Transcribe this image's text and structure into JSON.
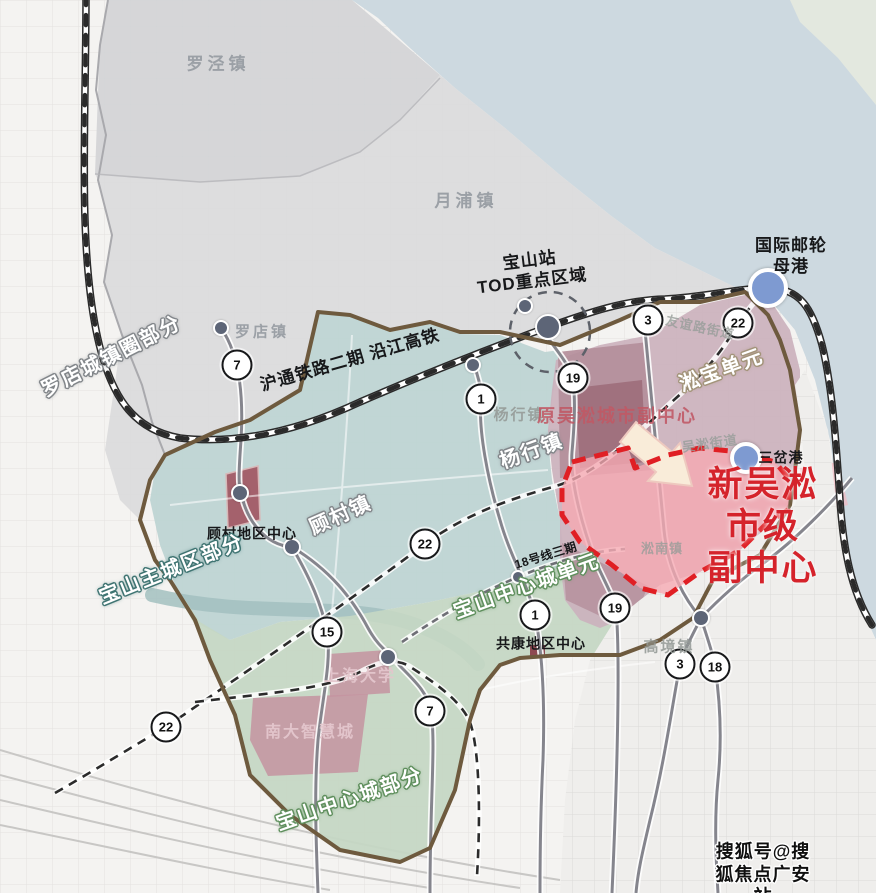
{
  "map": {
    "title_hint": "宝山区规划示意图",
    "colors": {
      "accent_red": "#d5232b",
      "dashed_zone_red": "#e01f24",
      "water": "#cdd9e0",
      "grey_region": "#d6d6d8",
      "teal_region": "#bdd3d2",
      "green_region": "#c5d7c4",
      "pink_region": "#cbb2bd",
      "pink_zone_fill": "#f6a9b2",
      "brown_boundary": "#6e5a3e",
      "port_marker_blue": "#7e9ad1"
    },
    "labels": [
      {
        "id": "luojing-town-label",
        "text": "罗泾镇",
        "x": 218,
        "y": 64,
        "rot": 0,
        "style": "town-grey"
      },
      {
        "id": "yuepu-town-label",
        "text": "月浦镇",
        "x": 466,
        "y": 201,
        "rot": 0,
        "style": "town-grey"
      },
      {
        "id": "luodian-town-label",
        "text": "罗店镇",
        "x": 262,
        "y": 333,
        "rot": 0,
        "style": "town-grey-sm"
      },
      {
        "id": "luodian-town-circle-part-label",
        "text": "罗店城镇圈部分",
        "x": 112,
        "y": 357,
        "rot": -27,
        "style": "outline sh-grey"
      },
      {
        "id": "hutong-railway-label",
        "text": "沪通铁路二期 沿江高铁",
        "x": 350,
        "y": 360,
        "rot": -16,
        "style": "black-bold md"
      },
      {
        "id": "baoshan-station-tod-label",
        "text": "宝山站\nTOD重点区域",
        "x": 531,
        "y": 271,
        "rot": -7,
        "style": "black-bold md"
      },
      {
        "id": "intl-cruise-port-label",
        "text": "国际邮轮母港",
        "x": 791,
        "y": 256,
        "rot": 0,
        "style": "black-bold md"
      },
      {
        "id": "songbao-unit-label",
        "text": "淞宝单元",
        "x": 722,
        "y": 371,
        "rot": -20,
        "style": "outline sh-tan"
      },
      {
        "id": "youyi-road-street-label",
        "text": "友谊路街道",
        "x": 700,
        "y": 328,
        "rot": 12,
        "style": "faded-grey-sm"
      },
      {
        "id": "yanghang-town-basemap-label",
        "text": "杨行镇",
        "x": 519,
        "y": 416,
        "rot": 0,
        "style": "faded-grey"
      },
      {
        "id": "former-wusong-city-subcenter-label",
        "text": "原吴淞城市副中心",
        "x": 617,
        "y": 416,
        "rot": 0,
        "style": "faded-red"
      },
      {
        "id": "yanghang-town-label",
        "text": "杨行镇",
        "x": 532,
        "y": 452,
        "rot": -20,
        "style": "outline sh-grey"
      },
      {
        "id": "wusong-street-label",
        "text": "吴淞街道",
        "x": 710,
        "y": 444,
        "rot": -8,
        "style": "faded-grey-sm"
      },
      {
        "id": "sanchagang-label",
        "text": "三岔港",
        "x": 781,
        "y": 458,
        "rot": 0,
        "style": "black-bold sm"
      },
      {
        "id": "new-wusong-city-subcenter-label",
        "text": "新吴淞市级\n副中心",
        "x": 763,
        "y": 527,
        "rot": 0,
        "style": "red-big"
      },
      {
        "id": "gucun-area-center-label",
        "text": "顾村地区中心",
        "x": 252,
        "y": 534,
        "rot": 0,
        "style": "black-bold sm"
      },
      {
        "id": "gucun-town-label",
        "text": "顾村镇",
        "x": 341,
        "y": 516,
        "rot": -24,
        "style": "outline sh-grey"
      },
      {
        "id": "baoshan-main-city-part-label",
        "text": "宝山主城区部分",
        "x": 172,
        "y": 570,
        "rot": -22,
        "style": "outline sh-teal"
      },
      {
        "id": "line18-phase3-label",
        "text": "18号线三期",
        "x": 546,
        "y": 556,
        "rot": -17,
        "style": "black-bold xs"
      },
      {
        "id": "songnan-town-label",
        "text": "淞南镇",
        "x": 662,
        "y": 549,
        "rot": 0,
        "style": "faded-grey-sm"
      },
      {
        "id": "baoshan-central-city-unit-label",
        "text": "宝山中心城单元",
        "x": 527,
        "y": 587,
        "rot": -20,
        "style": "outline sh-green"
      },
      {
        "id": "gongkang-area-center-label",
        "text": "共康地区中心",
        "x": 541,
        "y": 644,
        "rot": 0,
        "style": "black-bold sm"
      },
      {
        "id": "gaojing-town-label",
        "text": "高境镇",
        "x": 669,
        "y": 648,
        "rot": 0,
        "style": "faded-grey"
      },
      {
        "id": "shanghai-university-label",
        "text": "上海大学",
        "x": 360,
        "y": 677,
        "rot": 0,
        "style": "faded-pink"
      },
      {
        "id": "nanda-smart-city-label",
        "text": "南大智慧城",
        "x": 310,
        "y": 733,
        "rot": 0,
        "style": "faded-pink"
      },
      {
        "id": "baoshan-central-city-part-label",
        "text": "宝山中心城部分",
        "x": 350,
        "y": 800,
        "rot": -19,
        "style": "outline sh-green"
      },
      {
        "id": "watermark",
        "text": "搜狐号@搜狐焦点广安站",
        "x": 763,
        "y": 874,
        "rot": 0,
        "style": "watermark"
      }
    ],
    "line_badges": [
      {
        "line": "7",
        "x": 237,
        "y": 365
      },
      {
        "line": "1",
        "x": 481,
        "y": 399
      },
      {
        "line": "19",
        "x": 573,
        "y": 378
      },
      {
        "line": "3",
        "x": 648,
        "y": 320
      },
      {
        "line": "22",
        "x": 738,
        "y": 323
      },
      {
        "line": "22",
        "x": 425,
        "y": 544
      },
      {
        "line": "15",
        "x": 327,
        "y": 632
      },
      {
        "line": "7",
        "x": 430,
        "y": 711
      },
      {
        "line": "22",
        "x": 166,
        "y": 727
      },
      {
        "line": "1",
        "x": 535,
        "y": 615
      },
      {
        "line": "19",
        "x": 615,
        "y": 608
      },
      {
        "line": "3",
        "x": 680,
        "y": 664
      },
      {
        "line": "18",
        "x": 715,
        "y": 667
      }
    ],
    "station_dots": [
      {
        "id": "luodian-station-dot",
        "x": 221,
        "y": 328,
        "r": 6
      },
      {
        "id": "tod-minor-station-dot",
        "x": 525,
        "y": 306,
        "r": 6
      },
      {
        "id": "baoshan-station-dot",
        "x": 548,
        "y": 327,
        "r": 11
      },
      {
        "id": "line1-north-station-dot",
        "x": 473,
        "y": 365,
        "r": 6
      },
      {
        "id": "gucun-station-dot",
        "x": 240,
        "y": 493,
        "r": 7
      },
      {
        "id": "gucun-center-station-dot",
        "x": 292,
        "y": 547,
        "r": 7
      },
      {
        "id": "shanghai-univ-station-dot",
        "x": 388,
        "y": 657,
        "r": 7
      },
      {
        "id": "line18-phase3-station-dot",
        "x": 518,
        "y": 577,
        "r": 5
      },
      {
        "id": "gaojing-junction-dot",
        "x": 701,
        "y": 618,
        "r": 7
      }
    ],
    "port_markers": [
      {
        "id": "cruise-port-marker",
        "x": 768,
        "y": 288,
        "r": 16
      },
      {
        "id": "sanchagang-marker",
        "x": 746,
        "y": 458,
        "r": 12
      }
    ]
  }
}
